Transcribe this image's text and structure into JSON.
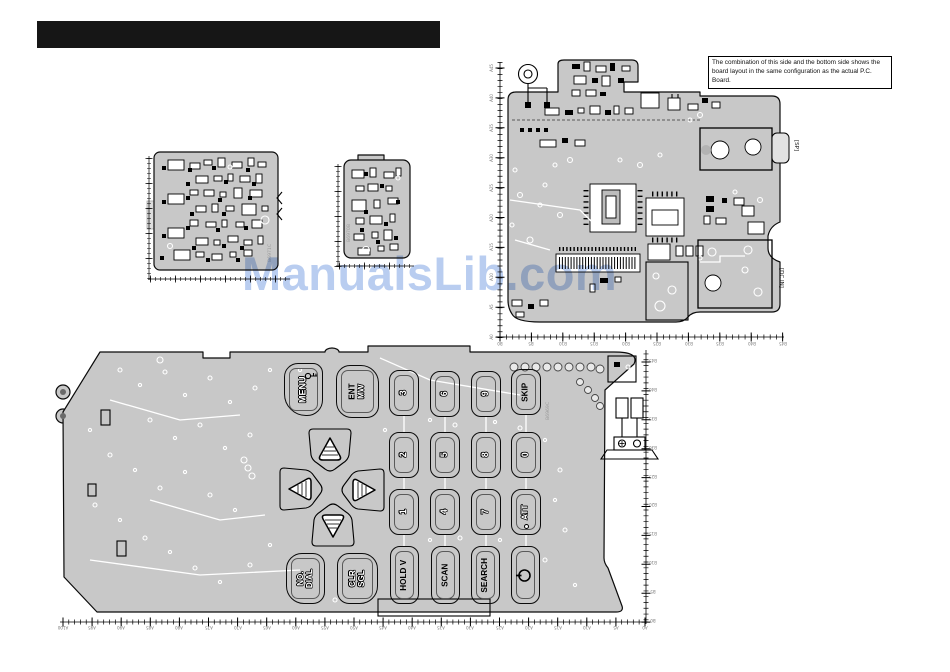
{
  "note_box": {
    "text": "The combination of this side and the bottom side shows the board layout in the same configuration as the actual P.C. Board."
  },
  "watermark": {
    "text": "ManualsLib.com",
    "color": "#b9cdf0"
  },
  "boards": {
    "left_board": {
      "silkscreen": "B6971C"
    },
    "small_board": {
      "silkscreen": "B6970B"
    },
    "keypad_board": {
      "silkscreen": "B6969C"
    },
    "main_board": {
      "sp_label": "[SP]",
      "dc_label": "[DC IN]"
    }
  },
  "keys": {
    "menu": {
      "label": "MENU"
    },
    "ent": {
      "line1": "ENT",
      "line2": "MW"
    },
    "k3": {
      "label": "3"
    },
    "k6": {
      "label": "6"
    },
    "k9": {
      "label": "9"
    },
    "skip": {
      "label": "SKIP"
    },
    "k2": {
      "label": "2"
    },
    "k5": {
      "label": "5"
    },
    "k8": {
      "label": "8"
    },
    "k0": {
      "label": "0"
    },
    "k1": {
      "label": "1"
    },
    "k4": {
      "label": "4"
    },
    "k7": {
      "label": "7"
    },
    "att": {
      "label": "ATT"
    },
    "no_dial": {
      "line1": "NO.",
      "line2": "DIAL"
    },
    "clr_sgl": {
      "line1": "CLR",
      "line2": "SGL"
    },
    "hold_v": {
      "label": "HOLD V"
    },
    "scan": {
      "label": "SCAN"
    },
    "search": {
      "label": "SEARCH"
    }
  },
  "rulers": {
    "keypad_h": [
      "A100",
      "A95",
      "A90",
      "A85",
      "A80",
      "A75",
      "A70",
      "A65",
      "A60",
      "A55",
      "A50",
      "A45",
      "A40",
      "A35",
      "A30",
      "A25",
      "A20",
      "A15",
      "A10",
      "A5",
      "A0"
    ],
    "keypad_v": [
      "B45",
      "B40",
      "B35",
      "B30",
      "B25",
      "B20",
      "B15",
      "B10",
      "B5",
      "B0"
    ],
    "main_v": [
      "A45",
      "A40",
      "A35",
      "A30",
      "A25",
      "A20",
      "A15",
      "A10",
      "A5",
      "A0"
    ],
    "main_h": [
      "B0",
      "B5",
      "B10",
      "B15",
      "B20",
      "B25",
      "B30",
      "B35",
      "B40",
      "B45"
    ]
  }
}
